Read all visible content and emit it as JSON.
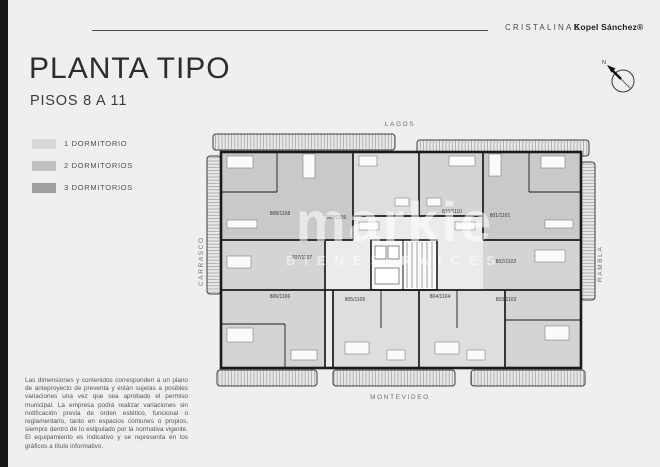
{
  "header": {
    "brand_left": "CRISTALINAS",
    "brand_right": "Kopel Sánchez®"
  },
  "title": {
    "main": "PLANTA TIPO",
    "subtitle": "PISOS 8 A 11"
  },
  "legend": {
    "items": [
      {
        "label": "1 DORMITORIO",
        "color": "#d8d8d6"
      },
      {
        "label": "2 DORMITORIOS",
        "color": "#c1c1bf"
      },
      {
        "label": "3 DORMITORIOS",
        "color": "#9f9f9d"
      }
    ]
  },
  "compass": {
    "north_label": "N"
  },
  "plan": {
    "streets": {
      "top": "LAGOS",
      "left": "CARRASCO",
      "right": "RAMBLA",
      "bottom": "MONTEVIDEO"
    },
    "units": [
      {
        "label": "808/1108"
      },
      {
        "label": "809/1109"
      },
      {
        "label": "810/1110"
      },
      {
        "label": "801/1101"
      },
      {
        "label": "807/1107"
      },
      {
        "label": "802/1102"
      },
      {
        "label": "806/1106"
      },
      {
        "label": "805/1105"
      },
      {
        "label": "804/1104"
      },
      {
        "label": "803/1103"
      }
    ]
  },
  "watermark": {
    "line1": "markie",
    "line2": "BIENES RAICES"
  },
  "disclaimer": {
    "text": "Las dimensiones y contenidos corresponden a un plano de anteproyecto de preventa y están sujetas a posibles variaciones una vez que sea aprobado el permiso municipal. La empresa podrá realizar variaciones sin notificación previa de orden estético, funcional o reglamentario, tanto en espacios comunes o propios, siempre dentro de lo estipulado por la normativa vigente. El equipamiento es indicativo y se representa en los gráficos a título informativo."
  },
  "colors": {
    "background": "#f0efed",
    "sidebar_bar": "#161616",
    "walls": "#1b1b1b",
    "unit_1dorm": "#dfdedc",
    "unit_2dorm": "#d4d4d2",
    "unit_3dorm": "#c9c9c7"
  }
}
